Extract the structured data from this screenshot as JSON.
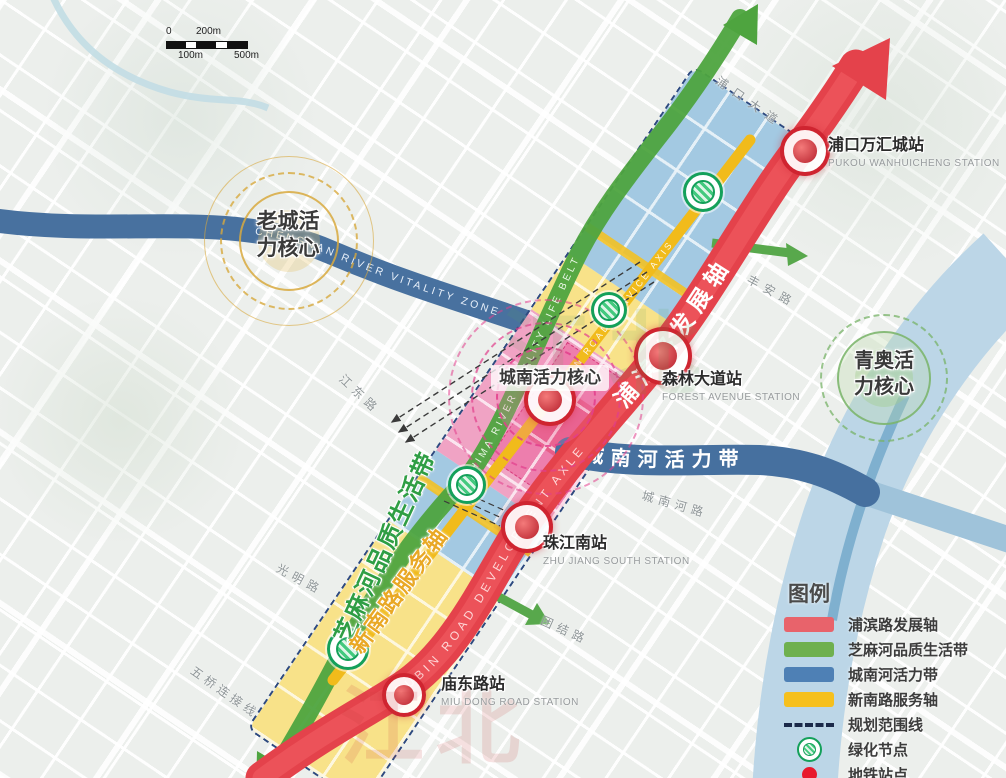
{
  "scale_bar": {
    "zero": "0",
    "two_hundred": "200m",
    "one_hundred": "100m",
    "five_hundred": "500m"
  },
  "watermark": "江北",
  "cores": {
    "old_city": {
      "line1": "老城活",
      "line2": "力核心"
    },
    "chengnan": {
      "label": "城南活力核心"
    },
    "qingao": {
      "line1": "青奥活",
      "line2": "力核心"
    }
  },
  "axes": {
    "pubin_cn": "浦滨路发展轴",
    "pubin_en": "PUBIN ROAD DEVELOPMENT AXLE",
    "zhima_cn": "芝麻河品质生活带",
    "zhima_en": "ZHIMA RIVER QUALITY LIFE BELT",
    "xinnan_cn": "新南路服务轴",
    "xinnan_en": "XINNAN ROAD SERVICE AXIS",
    "chengnan_river_cn": "城南河活力带",
    "chengnan_river_en": "CHENGNAN RIVER VITALITY ZONE"
  },
  "stations": [
    {
      "name": "浦口万汇城站",
      "en": "PUKOU WANHUICHENG STATION"
    },
    {
      "name": "森林大道站",
      "en": "FOREST AVENUE STATION"
    },
    {
      "name": "珠江南站",
      "en": "ZHU JIANG SOUTH STATION"
    },
    {
      "name": "庙东路站",
      "en": "MIU DONG ROAD STATION"
    }
  ],
  "roads": [
    "浦口大道",
    "丰安路",
    "江东路",
    "光明路",
    "五桥连接线",
    "团结路",
    "城南河路"
  ],
  "legend": {
    "title": "图例",
    "items": [
      {
        "label": "浦滨路发展轴",
        "swatch": "red-bar",
        "color": "#e8636b"
      },
      {
        "label": "芝麻河品质生活带",
        "swatch": "green-bar",
        "color": "#6fb04e"
      },
      {
        "label": "城南河活力带",
        "swatch": "blue-bar",
        "color": "#4e80b5"
      },
      {
        "label": "新南路服务轴",
        "swatch": "yellow-bar",
        "color": "#f6c01d"
      },
      {
        "label": "规划范围线",
        "swatch": "dashed-line",
        "color": "#1b2a4a"
      },
      {
        "label": "绿化节点",
        "swatch": "green-node",
        "color": "#27ae60"
      },
      {
        "label": "地铁站点",
        "swatch": "metro-dot",
        "color": "#e8192d"
      }
    ]
  },
  "colors": {
    "pubin_axis": "#e4424b",
    "zhima_belt": "#4ea43f",
    "chengnan_river": "#46709f",
    "xinnan_axis": "#f1bb1b",
    "planning_boundary": "#2e4a80"
  }
}
